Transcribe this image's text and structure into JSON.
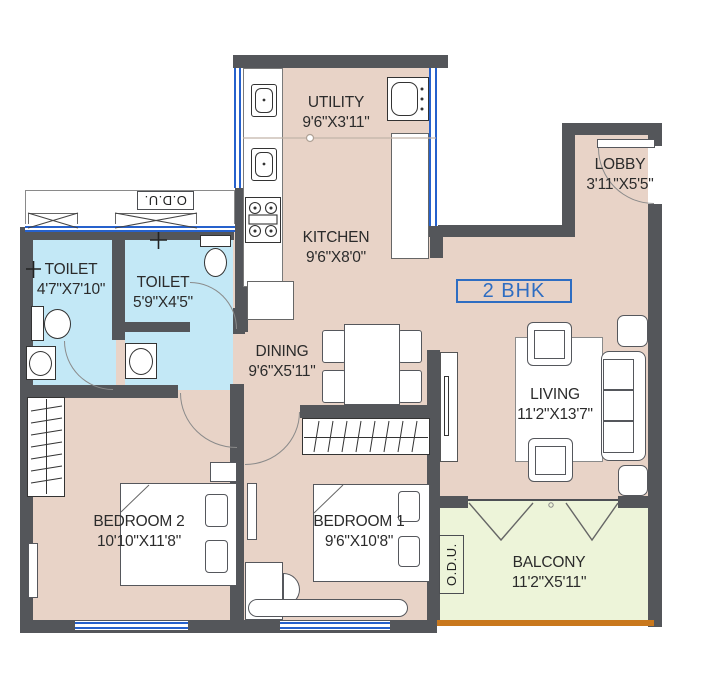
{
  "unit_label": "2 BHK",
  "odu_top": "O.D.U.",
  "odu_balcony": "O.D.U.",
  "rooms": {
    "utility": {
      "name": "UTILITY",
      "dims": "9'6\"X3'11\""
    },
    "kitchen": {
      "name": "KITCHEN",
      "dims": "9'6\"X8'0\""
    },
    "lobby": {
      "name": "LOBBY",
      "dims": "3'11\"X5'5\""
    },
    "toilet1": {
      "name": "TOILET",
      "dims": "4'7\"X7'10\""
    },
    "toilet2": {
      "name": "TOILET",
      "dims": "5'9\"X4'5\""
    },
    "dining": {
      "name": "DINING",
      "dims": "9'6\"X5'11\""
    },
    "living": {
      "name": "LIVING",
      "dims": "11'2\"X13'7\""
    },
    "bedroom2": {
      "name": "BEDROOM 2",
      "dims": "10'10\"X11'8\""
    },
    "bedroom1": {
      "name": "BEDROOM 1",
      "dims": "9'6\"X10'8\""
    },
    "balcony": {
      "name": "BALCONY",
      "dims": "11'2\"X5'11\""
    }
  },
  "colors": {
    "wall": "#54565a",
    "floor": "#e8d3c7",
    "toilet_floor": "#c3e8f6",
    "balcony_floor": "#edf4d9",
    "window": "#2661cc",
    "balcony_edge": "#c9781d",
    "label_text": "#2b2b2b",
    "accent_blue": "#2e6dc2"
  }
}
